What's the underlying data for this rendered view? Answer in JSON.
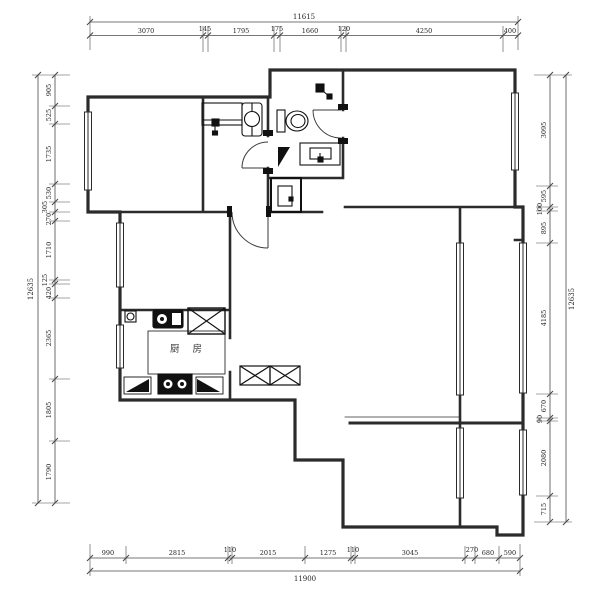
{
  "drawing": {
    "room_labels": {
      "kitchen": "厨 房"
    },
    "dimensions": {
      "top": {
        "total": "11615",
        "segments": [
          "3070",
          "145",
          "1795",
          "175",
          "1660",
          "120",
          "4250",
          "400"
        ]
      },
      "bottom": {
        "total": "11900",
        "segments": [
          "990",
          "2815",
          "110",
          "2015",
          "1275",
          "110",
          "3045",
          "270",
          "680",
          "590"
        ]
      },
      "left": {
        "total": "12635",
        "segments": [
          "905",
          "525",
          "1735",
          "530",
          "305",
          "270",
          "1710",
          "125",
          "420",
          "2365",
          "1805",
          "1790"
        ]
      },
      "right": {
        "total": "12635",
        "segments": [
          "3095",
          "595",
          "100",
          "895",
          "4185",
          "670",
          "90",
          "2080",
          "715"
        ]
      }
    },
    "colors": {
      "wall": "#2b2b2b",
      "dim_line": "#4a4a4a",
      "dim_text": "#1f1f1f"
    }
  }
}
